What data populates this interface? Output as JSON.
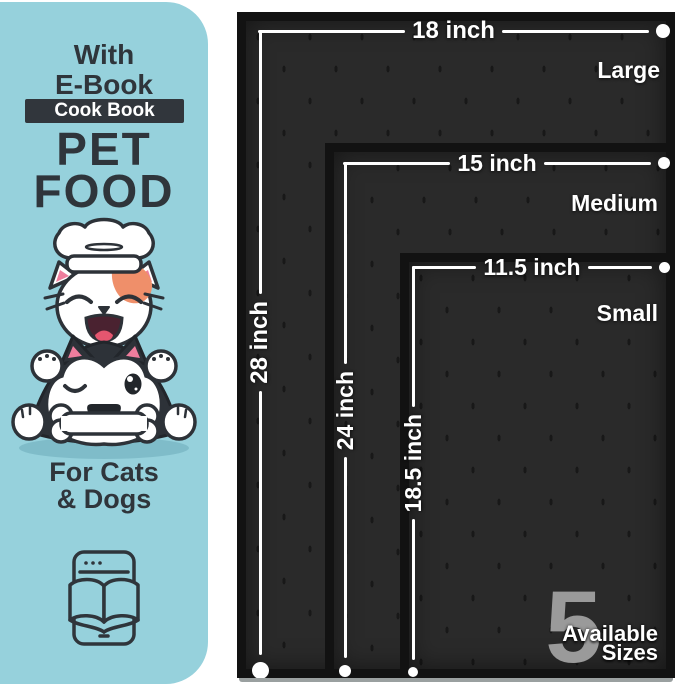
{
  "panel": {
    "eyebrow_line1": "With",
    "eyebrow_line2": "E-Book",
    "badge_label": "Cook Book",
    "title_line1": "PET",
    "title_line2": "FOOD",
    "subtitle_line1": "For Cats",
    "subtitle_line2": "& Dogs",
    "illustration": "cat-chef-and-husky-dog-with-bone",
    "icon": "ebook-tablet-icon"
  },
  "mats": {
    "large": {
      "name": "Large",
      "width": "18 inch",
      "height": "28 inch"
    },
    "medium": {
      "name": "Medium",
      "width": "15 inch",
      "height": "24 inch"
    },
    "small": {
      "name": "Small",
      "width": "11.5 inch",
      "height": "18.5 inch"
    }
  },
  "callout": {
    "count": "5",
    "word1": "Available",
    "word2": "Sizes"
  },
  "colors": {
    "panel_bg": "#96d1dc",
    "text_dark": "#2f353b",
    "badge_bg": "#31363c",
    "mat_surface": "#2a2a2a",
    "mat_edge": "#121212",
    "dimension_line": "#ffffff",
    "count_gray": "#9a9a9a",
    "patch_orange": "#ef8f6a",
    "ear_pink": "#ef7d9d"
  }
}
